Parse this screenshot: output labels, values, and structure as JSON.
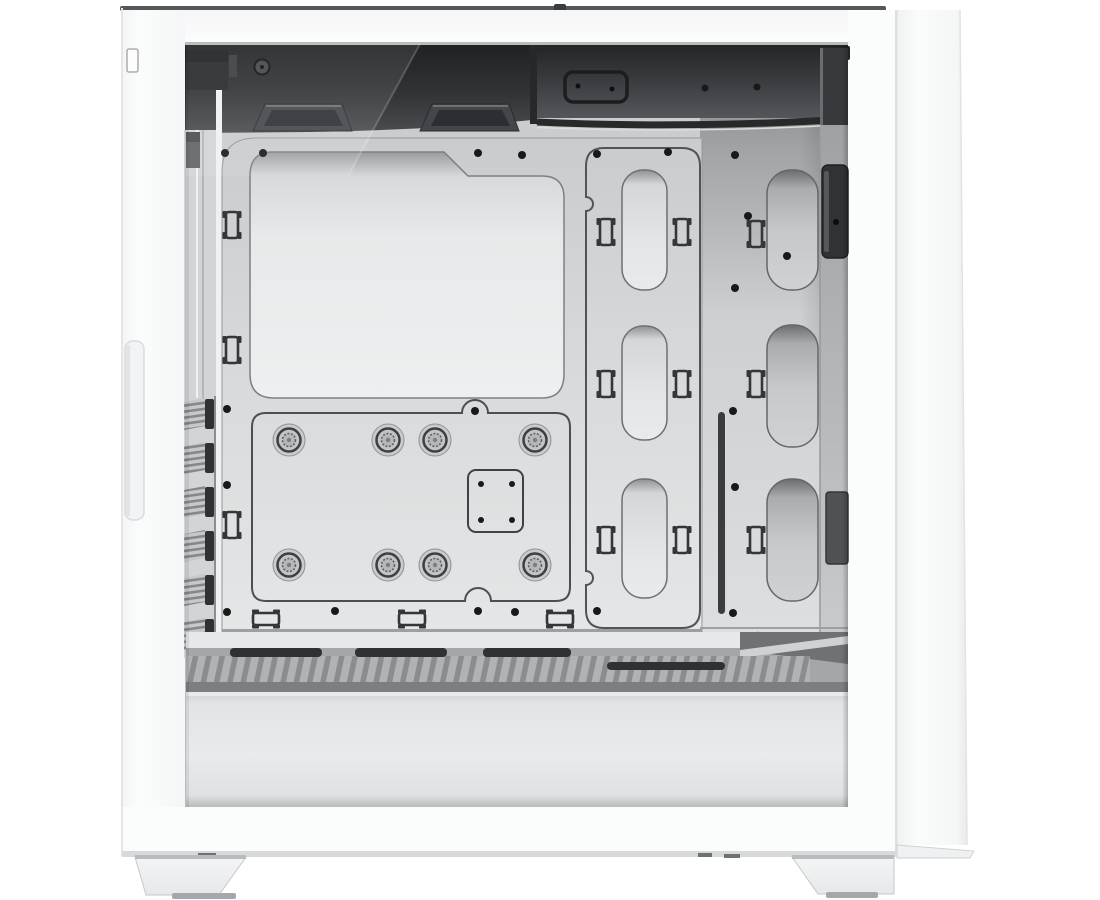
{
  "image": {
    "kind": "product-photo",
    "subject": "White mid-tower ATX PC case with side panel removed, interior view of motherboard tray and PSU shroud",
    "visible_text": "none"
  },
  "palette": {
    "background": "#ffffff",
    "case_white": "#fbfcfc",
    "frame_shadow": "#d7d9da",
    "interior_base": "#caccce",
    "top_shadow_dark": "#232527",
    "tray_light": "#d9dbdc",
    "cutout_light": "#e9ebec",
    "outline_dark": "#33363a",
    "shroud_top_gray": "#a4a7a9",
    "vent_slot_dark": "#2f3234",
    "screw_black": "#17191b",
    "rear_bracket_dark": "#37393c"
  },
  "parts": {
    "case_body": "white steel frame with tempered-glass side removed",
    "front_panel": "solid white front with recessed grip and small latch tab",
    "top_io_passthrough": "rounded cable pass-through plate with 2 screws",
    "fan_mount_pads": 2,
    "motherboard_tray": {
      "standoffs": 8,
      "cpu_cooler_cutout": 1,
      "itx_bracket_holes": 4
    },
    "cable_channel_cutouts": 3,
    "rear_cable_cutouts": 3,
    "cable_tie_clips_vertical": 12,
    "cable_tie_mounts_horizontal": 3,
    "front_vent_louvers": 6,
    "psu_shroud": {
      "top_vent_slots": 4,
      "hatched_vent_strip": true
    },
    "gpu_antisag_slot": 1,
    "feet": 2,
    "screw_holes": 26
  }
}
